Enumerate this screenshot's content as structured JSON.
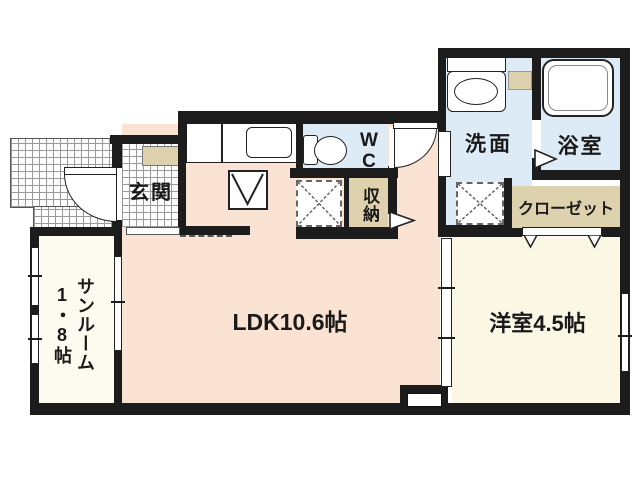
{
  "floor_plan": {
    "rooms": {
      "ldk": {
        "label": "LDK10.6帖"
      },
      "western": {
        "label": "洋室4.5帖"
      },
      "sunroom": {
        "label": "サンルーム",
        "size": "1・8帖"
      },
      "genkan": {
        "label": "玄関"
      },
      "wc": {
        "label": "WC",
        "line1": "W",
        "line2": "C"
      },
      "storage": {
        "label": "収納"
      },
      "washroom": {
        "label": "洗面"
      },
      "bathroom": {
        "label": "浴室"
      },
      "closet": {
        "label": "クローゼット"
      }
    },
    "colors": {
      "wall": "#1c1c1c",
      "ldk_floor": "#fae3d2",
      "room_floor": "#fbf7e5",
      "sunroom_floor": "#fdfbf0",
      "wet_room_floor": "#dcebf6",
      "storage_floor": "#ddd2ad",
      "tile_line": "#9a9a9a"
    }
  }
}
